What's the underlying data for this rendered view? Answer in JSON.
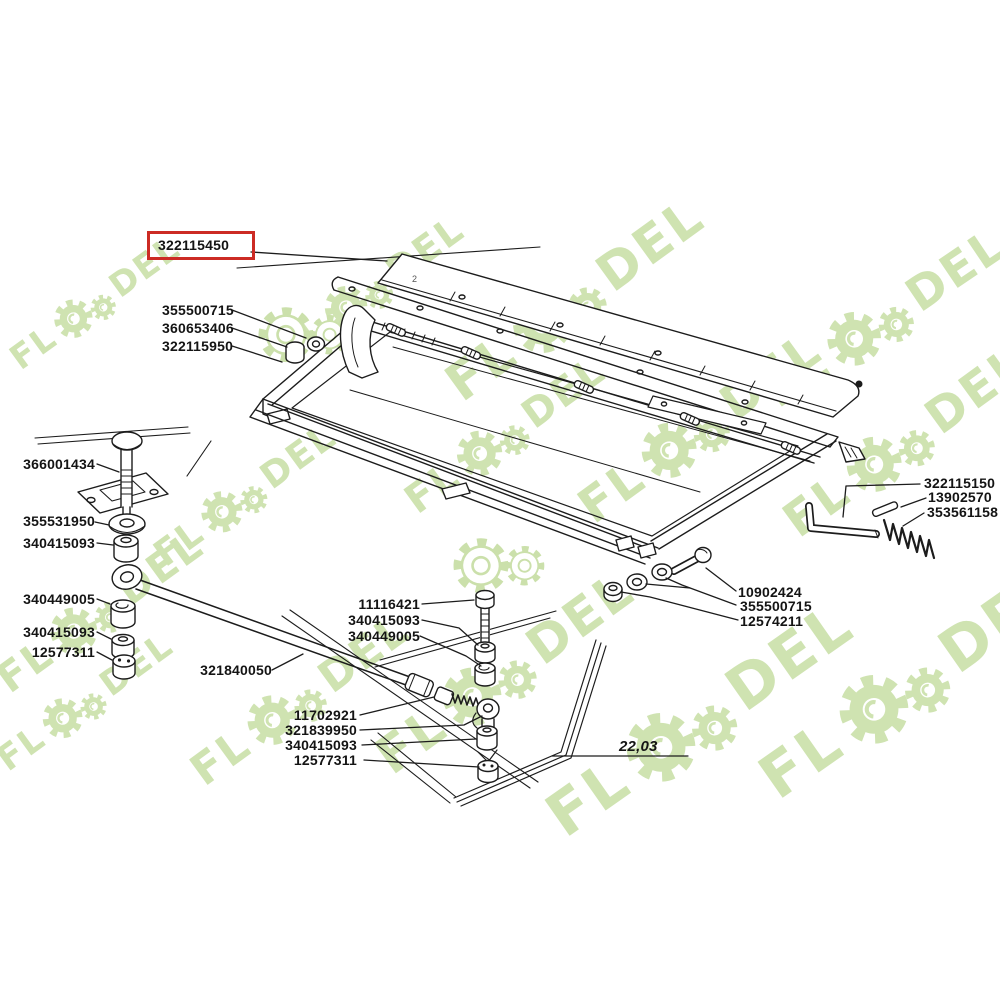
{
  "watermark": {
    "brand_left": "FL",
    "brand_right": "DEL"
  },
  "diagram": {
    "highlighted_part": {
      "number": "322115450"
    },
    "upper_left_labels": [
      "355500715",
      "360653406",
      "322115950"
    ],
    "left_labels": [
      "366001434",
      "355531950",
      "340415093",
      "340449005",
      "340415093",
      "12577311"
    ],
    "rod_label": "321840050",
    "center_upper_labels": [
      "11116421",
      "340415093",
      "340449005"
    ],
    "center_lower_labels": [
      "11702921",
      "321839950",
      "340415093",
      "12577311"
    ],
    "right_labels": [
      "322115150",
      "13902570",
      "353561158"
    ],
    "lower_right_labels": [
      "10902424",
      "355500715",
      "12574211"
    ],
    "reference_note": "22,03",
    "blade_mark": "2",
    "colors": {
      "highlight_box": "#cc2b24",
      "watermark_green": "#cfe3b1",
      "line": "#1c1c1c"
    }
  }
}
